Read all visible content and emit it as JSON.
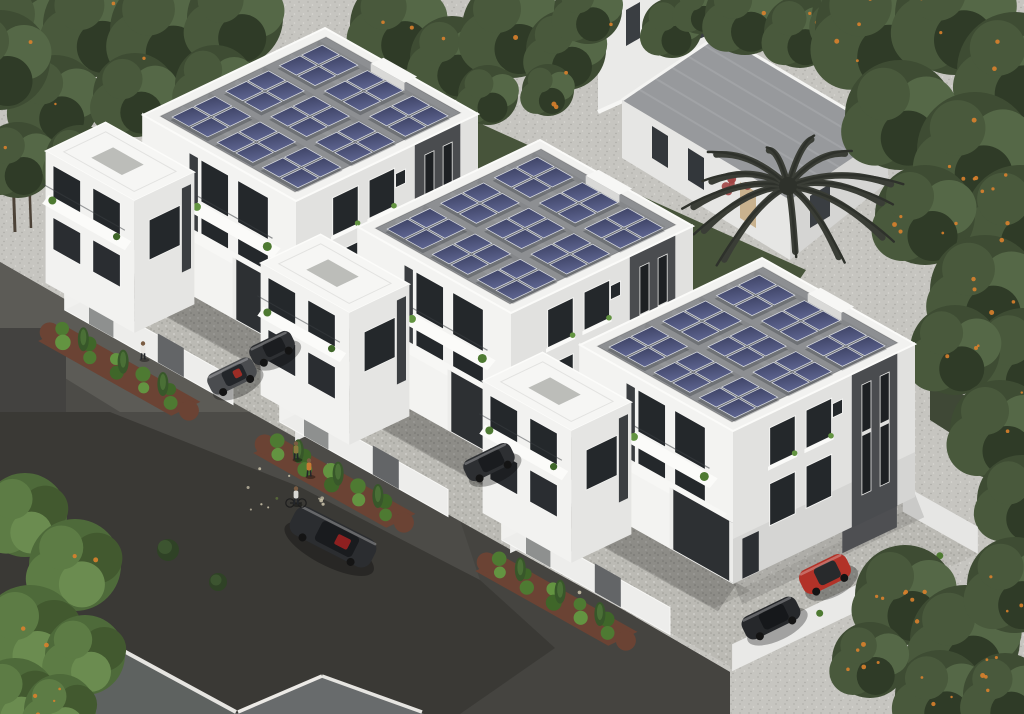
{
  "scene": {
    "description": "Aerial 3D architectural rendering of a residential development: three identical modern white three-storey villas arranged diagonally, each with a flat grey roof carrying nine dark-blue solar panel arrays (2x2 panels each), white perimeter walls, cobbled courtyards with parked cars and red quads, brick planter beds with hedges and conifers, a dark asphalt street with building shadows, two pedestrians, a child on a bicycle, a detached house with grey pitched roof and a dark palm tree behind, all surrounded by dense orange-fruited trees.",
    "image_type": "3D architectural aerial render",
    "time_of_day": "daytime"
  },
  "villas": {
    "count": 3,
    "stories": 3,
    "origins": [
      [
        325,
        28
      ],
      [
        540,
        140
      ],
      [
        762,
        258
      ]
    ],
    "roof": {
      "solar_array_rows": 3,
      "solar_array_cols": 3,
      "panels_per_array": 4,
      "total_panels_per_roof": 36
    }
  },
  "background": {
    "detached_house": {
      "roof_color": "#97999c",
      "wall_color": "#e6e6e4",
      "wall_shade": "#d5d5d3"
    },
    "partial_building_top": {
      "wall_color": "#eaeae8"
    },
    "palm": {
      "x": 788,
      "y": 186,
      "fronds": 13,
      "radius": 104,
      "color": "#3a3d36",
      "color_dark": "#2e312b"
    },
    "flower_cluster": {
      "x": 737,
      "y": 186,
      "color": "#a04444"
    }
  },
  "vehicles": [
    {
      "name": "grey-convertible",
      "layer": "street",
      "x": 232,
      "y": 376,
      "rot": -26,
      "length": 50,
      "width": 23,
      "color": "#4a4c4f",
      "roof": "#23262a",
      "accent": "#9c2d26"
    },
    {
      "name": "dark-car-driveway-1",
      "layer": "street",
      "x": 272,
      "y": 348,
      "rot": -26,
      "length": 46,
      "width": 21,
      "color": "#2e3033",
      "roof": "#1b1d20"
    },
    {
      "name": "red-quad-1",
      "layer": "court",
      "villa": 0,
      "x": 131,
      "y": 259,
      "rot": -26,
      "length": 24,
      "width": 14,
      "color": "#b5342c",
      "roof": "#2a2c2f"
    },
    {
      "name": "red-quad-2",
      "layer": "court",
      "villa": 1,
      "x": 344,
      "y": 372,
      "rot": -26,
      "length": 22,
      "width": 13,
      "color": "#bf382e",
      "roof": "#26282b"
    },
    {
      "name": "red-quad-3",
      "layer": "court",
      "villa": 2,
      "x": 566,
      "y": 490,
      "rot": -26,
      "length": 22,
      "width": 13,
      "color": "#bf382e",
      "roof": "#26282b"
    },
    {
      "name": "black-suv-carport-2",
      "layer": "street",
      "x": 489,
      "y": 462,
      "rot": -26,
      "length": 52,
      "width": 23,
      "color": "#2d2f32",
      "roof": "#1a1c1f"
    },
    {
      "name": "black-sports-street",
      "layer": "street",
      "x": 333,
      "y": 537,
      "rot": 27,
      "length": 90,
      "width": 31,
      "color": "#2b2d30",
      "roof": "#191b1e",
      "accent": "#8e2020"
    },
    {
      "name": "red-jeep",
      "layer": "street",
      "x": 825,
      "y": 574,
      "rot": -26,
      "length": 52,
      "width": 26,
      "color": "#b23228",
      "roof": "#282a2c"
    },
    {
      "name": "black-coupe",
      "layer": "street",
      "x": 771,
      "y": 618,
      "rot": -26,
      "length": 60,
      "width": 25,
      "color": "#26282b",
      "roof": "#16181b"
    }
  ],
  "people": [
    {
      "name": "man-standing",
      "x": 143,
      "y": 349,
      "shirt": "#e8e6e2"
    },
    {
      "name": "walker-1",
      "x": 296,
      "y": 449,
      "shirt": "#8a7a3e"
    },
    {
      "name": "walker-2",
      "x": 309,
      "y": 466,
      "shirt": "#c77a32"
    },
    {
      "name": "child-cyclist",
      "x": 296,
      "y": 494,
      "shirt": "#d8d8d4",
      "bike": true
    }
  ],
  "vegetation": {
    "orange_trees": true,
    "fruit_color": "#d9812c",
    "fruit_counts": {
      "top_left": 6,
      "top_center": 8,
      "top_right": 5,
      "right": 42,
      "bottom_left": 9,
      "bottom_right": 24
    }
  },
  "palette": {
    "gravel": "#c6c5c0",
    "cobble": "#bbbab4",
    "asphalt": "#4c4b47",
    "asphalt_shadow": "#3a3935",
    "asphalt_light": "#5c5b56",
    "asphalt_mid": "#454440",
    "asphalt_step": "#434240",
    "wall_bright": "#f3f3f1",
    "wall_shade": "#e1e1df",
    "parapet": "#f2f2f0",
    "roof_grey": "#8d8f92",
    "core_grey": "#4a4c4f",
    "glass": "#24282b",
    "panel_dark": "#3a3f60",
    "panel_light": "#5d6490",
    "panel_frame": "#dcdfe5",
    "hedge": [
      "#4e7a32",
      "#639441",
      "#3f6629"
    ],
    "conifer": "#38572a",
    "conifer_light": "#4a6f36",
    "planter_soil": "#6b4334",
    "canopy": [
      "#3e4c33",
      "#49593c",
      "#556847",
      "#2f3b27"
    ],
    "canopy_bright": [
      "#4e6a3a",
      "#5d7c45",
      "#42592f",
      "#6b8c50"
    ],
    "grass": "#47543a",
    "grass_dark": "#3f4836",
    "trunk": "#4c4237",
    "speckle": "#cfc7ae",
    "speckle2": "#b9b29c",
    "moss": "#5a6b3a",
    "bl_roof": "#5e6260",
    "bl_roof2": "#686b6c",
    "fascia": "#eceae6"
  }
}
